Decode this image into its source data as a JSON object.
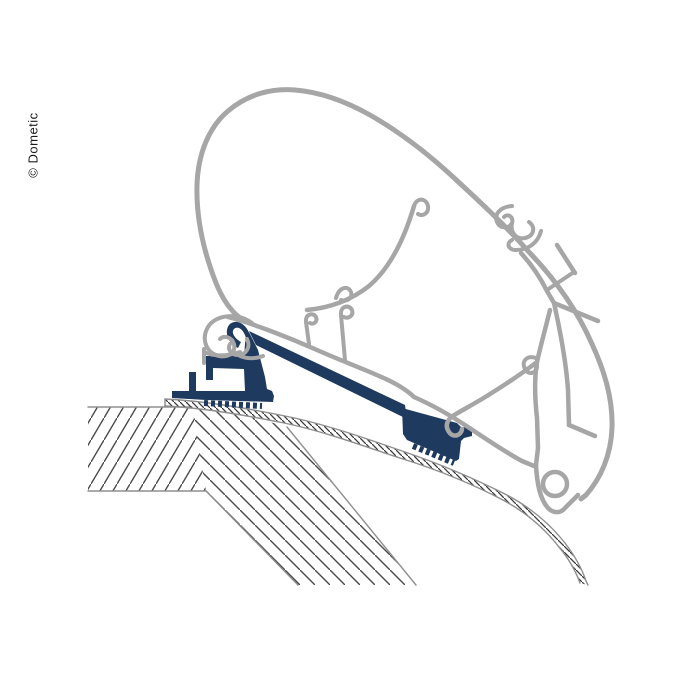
{
  "watermark": {
    "text": "© Dometic"
  },
  "diagram": {
    "title": "awning-roof-adapter-cross-section",
    "colors": {
      "background": "#ffffff",
      "profile_gray": "#a6a6a6",
      "adapter_navy": "#1e3a5f",
      "hatch_dark": "#4a4a4a",
      "edge_gray": "#8f8f8f"
    }
  }
}
